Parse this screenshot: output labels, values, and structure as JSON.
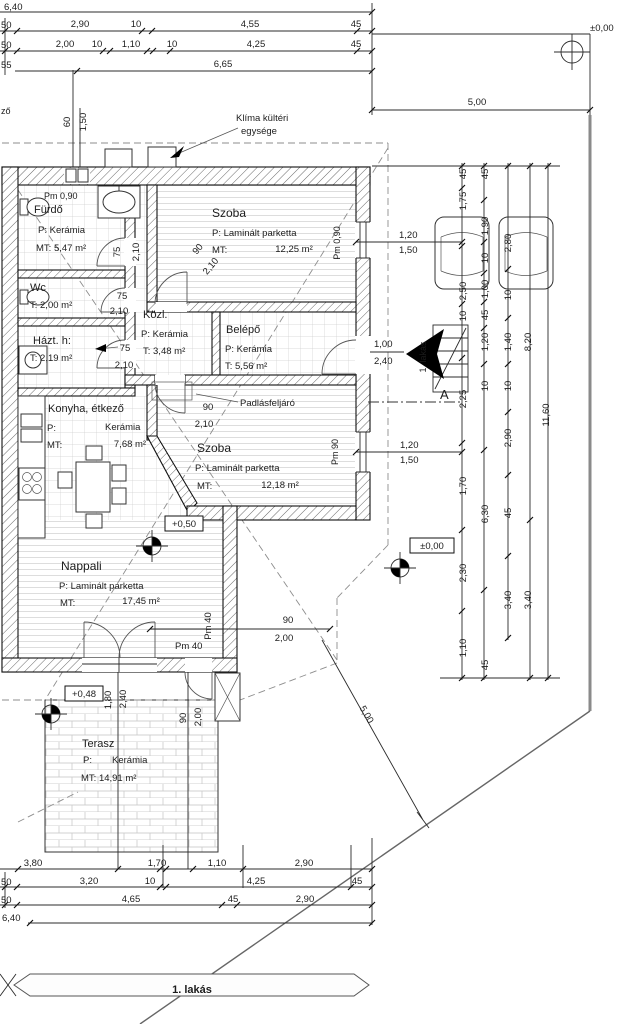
{
  "drawing": {
    "title": "1. lakás floor plan",
    "accent_colors": {
      "lines": "#1c1c1c",
      "property_line": "#8a8a8a",
      "pattern": "#cfcfcf"
    },
    "banner": {
      "label": "1. lakás"
    },
    "texts": [
      {
        "n": "dim-top-640",
        "t": "6,40",
        "x": 4,
        "y": 10
      },
      {
        "n": "dim-top-50a",
        "t": "50",
        "x": 1,
        "y": 28
      },
      {
        "n": "dim-top-290",
        "t": "2,90",
        "x": 80,
        "y": 27,
        "a": "m"
      },
      {
        "n": "dim-top-10a",
        "t": "10",
        "x": 136,
        "y": 27,
        "a": "m"
      },
      {
        "n": "dim-top-455",
        "t": "4,55",
        "x": 250,
        "y": 27,
        "a": "m"
      },
      {
        "n": "dim-top-45a",
        "t": "45",
        "x": 356,
        "y": 27,
        "a": "m"
      },
      {
        "n": "dim-top-50b",
        "t": "50",
        "x": 1,
        "y": 48
      },
      {
        "n": "dim-top-200",
        "t": "2,00",
        "x": 65,
        "y": 47,
        "a": "m"
      },
      {
        "n": "dim-top-10b",
        "t": "10",
        "x": 97,
        "y": 47,
        "a": "m"
      },
      {
        "n": "dim-top-110",
        "t": "1,10",
        "x": 131,
        "y": 47,
        "a": "m"
      },
      {
        "n": "dim-top-10c",
        "t": "10",
        "x": 172,
        "y": 47,
        "a": "m"
      },
      {
        "n": "dim-top-425",
        "t": "4,25",
        "x": 256,
        "y": 47,
        "a": "m"
      },
      {
        "n": "dim-top-45b",
        "t": "45",
        "x": 356,
        "y": 47,
        "a": "m"
      },
      {
        "n": "dim-top-55",
        "t": "55",
        "x": 1,
        "y": 68
      },
      {
        "n": "dim-top-665",
        "t": "6,65",
        "x": 223,
        "y": 67,
        "a": "m"
      },
      {
        "n": "level-street",
        "t": "±0,00",
        "x": 590,
        "y": 31
      },
      {
        "n": "dim-top-500",
        "t": "5,00",
        "x": 477,
        "y": 105,
        "a": "m"
      },
      {
        "n": "dim-left-60",
        "t": "60",
        "x": 70,
        "y": 122,
        "r": -90,
        "a": "m"
      },
      {
        "n": "dim-left-150",
        "t": "1,50",
        "x": 86,
        "y": 122,
        "r": -90,
        "a": "m"
      },
      {
        "n": "edge-fragment",
        "t": "ző",
        "x": 1,
        "y": 114,
        "s": 9
      },
      {
        "n": "klima-label-1",
        "t": "Klíma kültéri",
        "x": 236,
        "y": 121
      },
      {
        "n": "klima-label-2",
        "t": "egysége",
        "x": 241,
        "y": 134
      },
      {
        "n": "parapet-furdo",
        "t": "Pm 0,90",
        "x": 44,
        "y": 199,
        "s": 9
      },
      {
        "n": "room-furdo",
        "t": "Fürdő",
        "x": 34,
        "y": 213,
        "s": 11
      },
      {
        "n": "room-furdo-floor",
        "t": "P:  Kerámia",
        "x": 38,
        "y": 233
      },
      {
        "n": "room-furdo-area",
        "t": "MT: 5,47 m²",
        "x": 36,
        "y": 251
      },
      {
        "n": "door-furdo-w",
        "t": "75",
        "x": 120,
        "y": 252,
        "r": -90,
        "a": "m"
      },
      {
        "n": "door-furdo-h",
        "t": "2,10",
        "x": 139,
        "y": 252,
        "r": -90,
        "a": "m"
      },
      {
        "n": "room-szoba1",
        "t": "Szoba",
        "x": 212,
        "y": 217,
        "s": 12
      },
      {
        "n": "room-szoba1-floor",
        "t": "P: Laminált parketta",
        "x": 212,
        "y": 236
      },
      {
        "n": "room-szoba1-mt",
        "t": "MT:",
        "x": 212,
        "y": 253
      },
      {
        "n": "room-szoba1-area",
        "t": "12,25 m²",
        "x": 294,
        "y": 252,
        "a": "m"
      },
      {
        "n": "parapet-szoba1",
        "t": "Pm 0,90",
        "x": 340,
        "y": 243,
        "r": -90,
        "a": "m",
        "s": 9
      },
      {
        "n": "room-wc",
        "t": "Wc",
        "x": 30,
        "y": 291,
        "s": 11
      },
      {
        "n": "room-wc-area",
        "t": "T: 2,00 m²",
        "x": 30,
        "y": 308
      },
      {
        "n": "door-wc-w",
        "t": "75",
        "x": 122,
        "y": 299,
        "a": "m"
      },
      {
        "n": "door-wc-h",
        "t": "2,10",
        "x": 119,
        "y": 314,
        "a": "m"
      },
      {
        "n": "room-hazt",
        "t": "Házt. h:",
        "x": 33,
        "y": 344,
        "s": 11
      },
      {
        "n": "room-hazt-area",
        "t": "T: 2,19 m²",
        "x": 30,
        "y": 361
      },
      {
        "n": "door-hazt-w",
        "t": "75",
        "x": 125,
        "y": 351,
        "a": "m"
      },
      {
        "n": "door-hazt-h",
        "t": "2,10",
        "x": 124,
        "y": 368,
        "a": "m"
      },
      {
        "n": "room-kozl",
        "t": "Közl.",
        "x": 143,
        "y": 318,
        "s": 11
      },
      {
        "n": "room-kozl-floor",
        "t": "P: Kerámia",
        "x": 141,
        "y": 337
      },
      {
        "n": "room-kozl-area",
        "t": "T:  3,48 m²",
        "x": 143,
        "y": 354
      },
      {
        "n": "room-belepo",
        "t": "Belépő",
        "x": 226,
        "y": 333,
        "s": 11
      },
      {
        "n": "room-belepo-floor",
        "t": "P: Kerámia",
        "x": 225,
        "y": 352
      },
      {
        "n": "room-belepo-area",
        "t": "T:  5,56 m²",
        "x": 225,
        "y": 369
      },
      {
        "n": "door-entry-w",
        "t": "1,00",
        "x": 374,
        "y": 347
      },
      {
        "n": "door-entry-h",
        "t": "2,40",
        "x": 374,
        "y": 364
      },
      {
        "n": "window1-w",
        "t": "1,20",
        "x": 399,
        "y": 238
      },
      {
        "n": "window1-h",
        "t": "1,50",
        "x": 399,
        "y": 253
      },
      {
        "n": "door-szoba1-w",
        "t": "90",
        "x": 200,
        "y": 251,
        "r": -50,
        "a": "m"
      },
      {
        "n": "door-szoba1-h",
        "t": "2,10",
        "x": 213,
        "y": 268,
        "r": -50,
        "a": "m"
      },
      {
        "n": "door-szoba2-w",
        "t": "90",
        "x": 208,
        "y": 410,
        "a": "m"
      },
      {
        "n": "door-szoba2-h",
        "t": "2,10",
        "x": 204,
        "y": 427,
        "a": "m"
      },
      {
        "n": "attic-access-label",
        "t": "Padlásfeljáró",
        "x": 240,
        "y": 406
      },
      {
        "n": "room-szoba2",
        "t": "Szoba",
        "x": 197,
        "y": 452,
        "s": 12
      },
      {
        "n": "room-szoba2-floor",
        "t": "P: Laminált parketta",
        "x": 195,
        "y": 471
      },
      {
        "n": "room-szoba2-mt",
        "t": "MT:",
        "x": 197,
        "y": 489
      },
      {
        "n": "room-szoba2-area",
        "t": "12,18 m²",
        "x": 280,
        "y": 488,
        "a": "m"
      },
      {
        "n": "parapet-szoba2",
        "t": "Pm 90",
        "x": 338,
        "y": 452,
        "r": -90,
        "a": "m",
        "s": 9
      },
      {
        "n": "window2-w",
        "t": "1,20",
        "x": 400,
        "y": 448
      },
      {
        "n": "window2-h",
        "t": "1,50",
        "x": 400,
        "y": 463
      },
      {
        "n": "room-konyha",
        "t": "Konyha, étkező",
        "x": 48,
        "y": 412,
        "s": 11
      },
      {
        "n": "room-konyha-p",
        "t": "P:",
        "x": 47,
        "y": 431
      },
      {
        "n": "room-konyha-floor",
        "t": "Kerámia",
        "x": 105,
        "y": 430
      },
      {
        "n": "room-konyha-mt",
        "t": "MT:",
        "x": 47,
        "y": 448
      },
      {
        "n": "room-konyha-area",
        "t": "7,68 m²",
        "x": 130,
        "y": 447,
        "a": "m"
      },
      {
        "n": "level-living",
        "t": "+0,50",
        "x": 184,
        "y": 527,
        "a": "m"
      },
      {
        "n": "room-nappali",
        "t": "Nappali",
        "x": 61,
        "y": 570,
        "s": 12
      },
      {
        "n": "room-nappali-floor",
        "t": "P: Laminált parketta",
        "x": 59,
        "y": 589
      },
      {
        "n": "room-nappali-mt",
        "t": "MT:",
        "x": 60,
        "y": 606
      },
      {
        "n": "room-nappali-area",
        "t": "17,45 m²",
        "x": 141,
        "y": 604,
        "a": "m"
      },
      {
        "n": "level-ground",
        "t": "±0,00",
        "x": 432,
        "y": 549,
        "a": "m"
      },
      {
        "n": "entry-flat-label",
        "t": "1. lakás",
        "x": 426,
        "y": 357,
        "r": -90,
        "a": "m",
        "s": 9,
        "c": "#333"
      },
      {
        "n": "section-marker-a",
        "t": "A",
        "x": 440,
        "y": 399,
        "s": 13
      },
      {
        "n": "chain1-45a",
        "t": "45",
        "x": 466,
        "y": 174,
        "r": -90,
        "a": "m"
      },
      {
        "n": "chain1-175",
        "t": "1,75",
        "x": 466,
        "y": 201,
        "r": -90,
        "a": "m"
      },
      {
        "n": "chain1-250",
        "t": "2,50",
        "x": 466,
        "y": 291,
        "r": -90,
        "a": "m"
      },
      {
        "n": "chain1-10",
        "t": "10",
        "x": 466,
        "y": 316,
        "r": -90,
        "a": "m"
      },
      {
        "n": "chain1-225",
        "t": "2,25",
        "x": 466,
        "y": 399,
        "r": -90,
        "a": "m"
      },
      {
        "n": "chain1-170",
        "t": "1,70",
        "x": 466,
        "y": 486,
        "r": -90,
        "a": "m"
      },
      {
        "n": "chain1-230",
        "t": "2,30",
        "x": 466,
        "y": 573,
        "r": -90,
        "a": "m"
      },
      {
        "n": "chain1-110",
        "t": "1,10",
        "x": 466,
        "y": 648,
        "r": -90,
        "a": "m"
      },
      {
        "n": "chain2-45a",
        "t": "45",
        "x": 488,
        "y": 174,
        "r": -90,
        "a": "m"
      },
      {
        "n": "chain2-190",
        "t": "1,90",
        "x": 488,
        "y": 226,
        "r": -90,
        "a": "m"
      },
      {
        "n": "chain2-10a",
        "t": "10",
        "x": 488,
        "y": 258,
        "r": -90,
        "a": "m"
      },
      {
        "n": "chain2-100",
        "t": "1,00",
        "x": 488,
        "y": 289,
        "r": -90,
        "a": "m"
      },
      {
        "n": "chain2-45b",
        "t": "45",
        "x": 488,
        "y": 315,
        "r": -90,
        "a": "m"
      },
      {
        "n": "chain2-120",
        "t": "1,20",
        "x": 488,
        "y": 342,
        "r": -90,
        "a": "m"
      },
      {
        "n": "chain2-10b",
        "t": "10",
        "x": 488,
        "y": 386,
        "r": -90,
        "a": "m"
      },
      {
        "n": "chain2-630",
        "t": "6,30",
        "x": 488,
        "y": 514,
        "r": -90,
        "a": "m"
      },
      {
        "n": "chain2-45c",
        "t": "45",
        "x": 488,
        "y": 665,
        "r": -90,
        "a": "m"
      },
      {
        "n": "chain3-280",
        "t": "2,80",
        "x": 511,
        "y": 243,
        "r": -90,
        "a": "m"
      },
      {
        "n": "chain3-10a",
        "t": "10",
        "x": 511,
        "y": 295,
        "r": -90,
        "a": "m"
      },
      {
        "n": "chain3-140",
        "t": "1,40",
        "x": 511,
        "y": 342,
        "r": -90,
        "a": "m"
      },
      {
        "n": "chain3-10b",
        "t": "10",
        "x": 511,
        "y": 386,
        "r": -90,
        "a": "m"
      },
      {
        "n": "chain3-290",
        "t": "2,90",
        "x": 511,
        "y": 438,
        "r": -90,
        "a": "m"
      },
      {
        "n": "chain3-45",
        "t": "45",
        "x": 511,
        "y": 513,
        "r": -90,
        "a": "m"
      },
      {
        "n": "chain3-340",
        "t": "3,40",
        "x": 511,
        "y": 600,
        "r": -90,
        "a": "m"
      },
      {
        "n": "chain4-820",
        "t": "8,20",
        "x": 531,
        "y": 342,
        "r": -90,
        "a": "m"
      },
      {
        "n": "chain4-340",
        "t": "3,40",
        "x": 531,
        "y": 600,
        "r": -90,
        "a": "m"
      },
      {
        "n": "chain5-1160",
        "t": "11,60",
        "x": 549,
        "y": 415,
        "r": -90,
        "a": "m"
      },
      {
        "n": "parapet-nappali-h",
        "t": "Pm 40",
        "x": 175,
        "y": 649
      },
      {
        "n": "parapet-nappali-v",
        "t": "Pm 40",
        "x": 211,
        "y": 626,
        "r": -90,
        "a": "m"
      },
      {
        "n": "door-terasz-w",
        "t": "1,80",
        "x": 111,
        "y": 700,
        "r": -90,
        "a": "m"
      },
      {
        "n": "door-terasz-h",
        "t": "2,40",
        "x": 126,
        "y": 699,
        "r": -90,
        "a": "m"
      },
      {
        "n": "door-terasz2-w",
        "t": "90",
        "x": 186,
        "y": 718,
        "r": -90,
        "a": "m"
      },
      {
        "n": "door-terasz2-h",
        "t": "2,00",
        "x": 201,
        "y": 717,
        "r": -90,
        "a": "m"
      },
      {
        "n": "dim-gate-90",
        "t": "90",
        "x": 288,
        "y": 623,
        "a": "m"
      },
      {
        "n": "dim-gate-200",
        "t": "2,00",
        "x": 284,
        "y": 641,
        "a": "m"
      },
      {
        "n": "dim-diag-500",
        "t": "5,00",
        "x": 364,
        "y": 716,
        "r": 60,
        "a": "m"
      },
      {
        "n": "level-terasz",
        "t": "+0,48",
        "x": 84,
        "y": 697,
        "a": "m"
      },
      {
        "n": "room-terasz",
        "t": "Terasz",
        "x": 82,
        "y": 747,
        "s": 11
      },
      {
        "n": "room-terasz-p",
        "t": "P:",
        "x": 83,
        "y": 763
      },
      {
        "n": "room-terasz-floor",
        "t": "Kerámia",
        "x": 112,
        "y": 763
      },
      {
        "n": "room-terasz-area",
        "t": "MT: 14,91 m²",
        "x": 81,
        "y": 781
      },
      {
        "n": "dim-bot-380",
        "t": "3,80",
        "x": 33,
        "y": 866,
        "a": "m"
      },
      {
        "n": "dim-bot-170",
        "t": "1,70",
        "x": 157,
        "y": 866,
        "a": "m"
      },
      {
        "n": "dim-bot-110",
        "t": "1,10",
        "x": 217,
        "y": 866,
        "a": "m"
      },
      {
        "n": "dim-bot-290a",
        "t": "2,90",
        "x": 304,
        "y": 866,
        "a": "m"
      },
      {
        "n": "dim-bot-50a",
        "t": "50",
        "x": 1,
        "y": 885
      },
      {
        "n": "dim-bot-320",
        "t": "3,20",
        "x": 89,
        "y": 884,
        "a": "m"
      },
      {
        "n": "dim-bot-10",
        "t": "10",
        "x": 150,
        "y": 884,
        "a": "m"
      },
      {
        "n": "dim-bot-425",
        "t": "4,25",
        "x": 256,
        "y": 884,
        "a": "m"
      },
      {
        "n": "dim-bot-45a",
        "t": "45",
        "x": 357,
        "y": 884,
        "a": "m"
      },
      {
        "n": "dim-bot-50b",
        "t": "50",
        "x": 1,
        "y": 903
      },
      {
        "n": "dim-bot-465",
        "t": "4,65",
        "x": 131,
        "y": 902,
        "a": "m"
      },
      {
        "n": "dim-bot-45b",
        "t": "45",
        "x": 233,
        "y": 902,
        "a": "m"
      },
      {
        "n": "dim-bot-290b",
        "t": "2,90",
        "x": 305,
        "y": 902,
        "a": "m"
      },
      {
        "n": "dim-bot-640",
        "t": "6,40",
        "x": 2,
        "y": 921
      },
      {
        "n": "banner-label",
        "t": "1. lakás",
        "x": 192,
        "y": 993,
        "a": "m",
        "s": 11,
        "w": "bold",
        "c": "#777"
      }
    ]
  }
}
